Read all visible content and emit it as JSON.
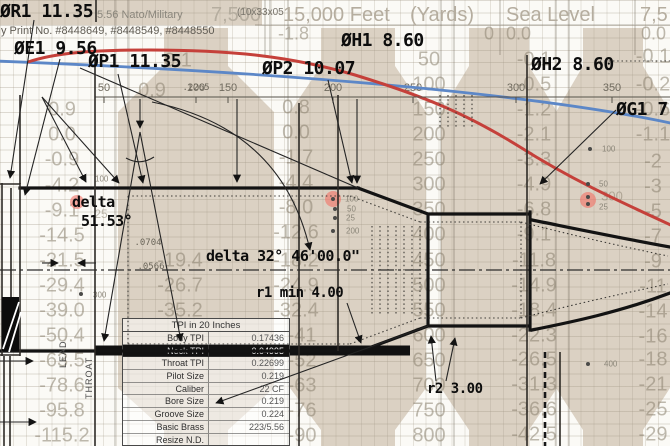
{
  "bg": {
    "top": {
      "nato": "5.56 Nato/Military",
      "alt7500": "7,500",
      "code": "(10x33x05",
      "feet15": "15,000 Feet",
      "yards": "(Yards)",
      "sea": "Sea Level",
      "right": "7,5",
      "print": "y Print No. #8448649, #8448549, #8448550"
    },
    "row2": [
      {
        "x": 278,
        "t": "-1.8"
      },
      {
        "x": 484,
        "t": "0"
      },
      {
        "x": 506,
        "t": "0.0"
      },
      {
        "x": 641,
        "t": "0.0"
      }
    ],
    "faint": [
      {
        "x": 62,
        "y": 110,
        "t": "0.9"
      },
      {
        "x": 62,
        "y": 135,
        "t": "0.0"
      },
      {
        "x": 62,
        "y": 160,
        "t": "-0.9"
      },
      {
        "x": 62,
        "y": 186,
        "t": "-4.2"
      },
      {
        "x": 62,
        "y": 211,
        "t": "-9.1"
      },
      {
        "x": 62,
        "y": 236,
        "t": "-14.5"
      },
      {
        "x": 62,
        "y": 261,
        "t": "-21.5"
      },
      {
        "x": 62,
        "y": 286,
        "t": "-29.4"
      },
      {
        "x": 62,
        "y": 311,
        "t": "-39.0"
      },
      {
        "x": 62,
        "y": 336,
        "t": "-50.4"
      },
      {
        "x": 62,
        "y": 361,
        "t": "-63.5"
      },
      {
        "x": 62,
        "y": 386,
        "t": "-78.6"
      },
      {
        "x": 62,
        "y": 411,
        "t": "-95.8"
      },
      {
        "x": 62,
        "y": 436,
        "t": "-115.2"
      },
      {
        "x": 178,
        "y": 61,
        "t": "0.1"
      },
      {
        "x": 152,
        "y": 91,
        "t": "0.9"
      },
      {
        "x": 180,
        "y": 261,
        "t": "-19.4"
      },
      {
        "x": 180,
        "y": 286,
        "t": "-26.7"
      },
      {
        "x": 180,
        "y": 311,
        "t": "-35.2"
      },
      {
        "x": 296,
        "y": 108,
        "t": "0.8"
      },
      {
        "x": 296,
        "y": 133,
        "t": "0.0"
      },
      {
        "x": 296,
        "y": 158,
        "t": "-1.7"
      },
      {
        "x": 296,
        "y": 183,
        "t": "-4.4"
      },
      {
        "x": 296,
        "y": 208,
        "t": "-8.0"
      },
      {
        "x": 296,
        "y": 233,
        "t": "-12.6"
      },
      {
        "x": 296,
        "y": 261,
        "t": "-18.2"
      },
      {
        "x": 296,
        "y": 286,
        "t": "-24.9"
      },
      {
        "x": 296,
        "y": 311,
        "t": "-32.4"
      },
      {
        "x": 302,
        "y": 336,
        "t": "-41"
      },
      {
        "x": 302,
        "y": 361,
        "t": "-52"
      },
      {
        "x": 302,
        "y": 386,
        "t": "-63"
      },
      {
        "x": 302,
        "y": 411,
        "t": "-76"
      },
      {
        "x": 302,
        "y": 436,
        "t": "-90"
      },
      {
        "x": 534,
        "y": 60,
        "t": "-0.1"
      },
      {
        "x": 534,
        "y": 85,
        "t": "-0.5"
      },
      {
        "x": 534,
        "y": 110,
        "t": "-1.2"
      },
      {
        "x": 534,
        "y": 135,
        "t": "-2.1"
      },
      {
        "x": 534,
        "y": 160,
        "t": "-3.3"
      },
      {
        "x": 534,
        "y": 185,
        "t": "-4.9"
      },
      {
        "x": 534,
        "y": 210,
        "t": "-6.8"
      },
      {
        "x": 534,
        "y": 235,
        "t": "-9.1"
      },
      {
        "x": 534,
        "y": 261,
        "t": "-11.8"
      },
      {
        "x": 534,
        "y": 286,
        "t": "-14.9"
      },
      {
        "x": 534,
        "y": 311,
        "t": "-18.4"
      },
      {
        "x": 534,
        "y": 336,
        "t": "-22.3"
      },
      {
        "x": 534,
        "y": 360,
        "t": "-26.5"
      },
      {
        "x": 534,
        "y": 385,
        "t": "-31.3"
      },
      {
        "x": 534,
        "y": 410,
        "t": "-36.6"
      },
      {
        "x": 534,
        "y": 435,
        "t": "-42.5"
      },
      {
        "x": 653,
        "y": 57,
        "t": "-0.1"
      },
      {
        "x": 653,
        "y": 85,
        "t": "-0.2"
      },
      {
        "x": 653,
        "y": 110,
        "t": "-0.6"
      },
      {
        "x": 653,
        "y": 135,
        "t": "-1.1"
      },
      {
        "x": 653,
        "y": 162,
        "t": "-2"
      },
      {
        "x": 653,
        "y": 187,
        "t": "-3"
      },
      {
        "x": 653,
        "y": 212,
        "t": "-5"
      },
      {
        "x": 653,
        "y": 237,
        "t": "-7"
      },
      {
        "x": 653,
        "y": 262,
        "t": "-9"
      },
      {
        "x": 653,
        "y": 287,
        "t": "-11"
      },
      {
        "x": 653,
        "y": 312,
        "t": "-14"
      },
      {
        "x": 653,
        "y": 337,
        "t": "-16"
      },
      {
        "x": 653,
        "y": 360,
        "t": "-18"
      },
      {
        "x": 653,
        "y": 385,
        "t": "-21"
      },
      {
        "x": 653,
        "y": 410,
        "t": "-25"
      },
      {
        "x": 653,
        "y": 435,
        "t": "-29"
      },
      {
        "x": 612,
        "y": 196,
        "t": "300",
        "s": 13
      },
      {
        "x": 101,
        "y": 214,
        "t": "25",
        "s": 12
      }
    ],
    "range": {
      "x": 429,
      "y0": 60,
      "step": 25.07,
      "values": [
        "50",
        "100",
        "150",
        "200",
        "250",
        "300",
        "350",
        "400",
        "450",
        "500",
        "550",
        "600",
        "650",
        "700",
        "750",
        "800"
      ]
    },
    "ruler": {
      "y": 88,
      "ticks": [
        {
          "x": 104,
          "t": "50"
        },
        {
          "x": 196,
          "t": "100"
        },
        {
          "x": 228,
          "t": "150"
        },
        {
          "x": 333,
          "t": "200"
        },
        {
          "x": 413,
          "t": "250"
        },
        {
          "x": 516,
          "t": "300"
        },
        {
          "x": 612,
          "t": "350"
        }
      ]
    },
    "markers": {
      "pink": [
        [
          77,
          202,
          7
        ],
        [
          333,
          199,
          8
        ],
        [
          588,
          200,
          8
        ]
      ],
      "dots": [
        [
          333,
          199
        ],
        [
          335,
          209
        ],
        [
          335,
          218
        ],
        [
          333,
          231
        ],
        [
          83,
          178
        ],
        [
          81,
          294
        ],
        [
          590,
          149
        ],
        [
          588,
          184
        ],
        [
          588,
          197
        ],
        [
          588,
          204
        ],
        [
          588,
          364
        ]
      ],
      "labels": [
        {
          "x": 345,
          "y": 199,
          "t": "100"
        },
        {
          "x": 347,
          "y": 209,
          "t": "50"
        },
        {
          "x": 346,
          "y": 218,
          "t": "25"
        },
        {
          "x": 346,
          "y": 231,
          "t": "200"
        },
        {
          "x": 95,
          "y": 179,
          "t": "100"
        },
        {
          "x": 93,
          "y": 295,
          "t": "300"
        },
        {
          "x": 602,
          "y": 149,
          "t": "100"
        },
        {
          "x": 599,
          "y": 184,
          "t": "50"
        },
        {
          "x": 599,
          "y": 207,
          "t": "25"
        },
        {
          "x": 604,
          "y": 364,
          "t": "400"
        }
      ]
    }
  },
  "cad": {
    "labels": {
      "r1": "ØR1 11.35",
      "e1": "ØE1 9.56",
      "p1": "ØP1 11.35",
      "p2": "ØP2 10.07",
      "h1": "ØH1 8.60",
      "h2": "ØH2 8.60",
      "g1": "ØG1 7",
      "d1a": "delta",
      "d1b": "51.53°",
      "d2": "delta 32° 46'00.0\"",
      "r1min": "r1 min 4.00",
      "r2": "r2 3.00"
    },
    "tiny": [
      {
        "x": 196,
        "y": 88,
        "t": ".2265"
      },
      {
        "x": 148,
        "y": 243,
        "t": ".0704"
      },
      {
        "x": 151,
        "y": 267,
        "t": ".0566"
      }
    ],
    "lead": "LEAD",
    "throat": "THROAT",
    "table": {
      "title": "TPI in 20 Inches",
      "rows": [
        {
          "label": "Body TPI",
          "value": "0.17436"
        },
        {
          "label": "Neck TPI",
          "value": "0.04995"
        },
        {
          "label": "Throat TPI",
          "value": "0.22699"
        },
        {
          "label": "Pilot Size",
          "value": "0.219"
        },
        {
          "label": "Caliber",
          "value": "22 CF"
        },
        {
          "label": "Bore Size",
          "value": "0.219"
        },
        {
          "label": "Groove Size",
          "value": "0.224"
        },
        {
          "label": "Basic Brass",
          "value": "223/5.56"
        },
        {
          "label": "Resize N.D.",
          "value": ""
        }
      ]
    },
    "colors": {
      "red_curve": "#c5403a",
      "blue_curve": "#5c87c7",
      "beige": "#dbd1c3",
      "marker_pink": "#f27064"
    }
  }
}
